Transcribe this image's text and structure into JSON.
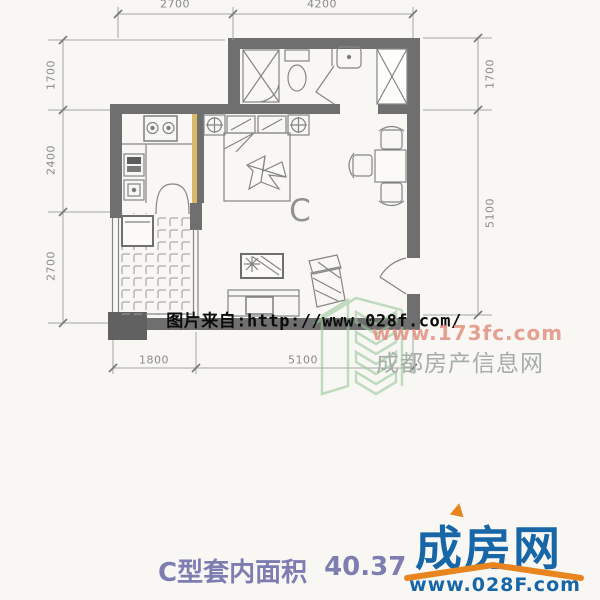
{
  "colors": {
    "wall": "#6f6f6f",
    "plan_line": "#858585",
    "accent_yellow": "#d9b96a",
    "watermark_black": "#0c0c0c",
    "watermark_red": "#e29181",
    "watermark_gray": "#a6aea8",
    "watermark_green": "#9cc89c",
    "area_text_purple": "#7d7db2",
    "brand_blue": "#1766a8",
    "brand_orange": "#e8851e"
  },
  "plan": {
    "unit_label": "C",
    "dimensions": {
      "top": [
        "2700",
        "4200"
      ],
      "left": [
        "1700",
        "2400",
        "2700"
      ],
      "right": [
        "1700",
        "5100"
      ],
      "bottom": [
        "1800",
        "5100"
      ]
    }
  },
  "watermark": {
    "source_text": "图片来自:http://www.028f.com/",
    "site_url": "www.173fc.com",
    "site_name": "成都房产信息网"
  },
  "footer": {
    "area_label": "C型套内面积",
    "area_value": "40.37",
    "brand_name": "成房网",
    "brand_url": "www.028F.com"
  }
}
